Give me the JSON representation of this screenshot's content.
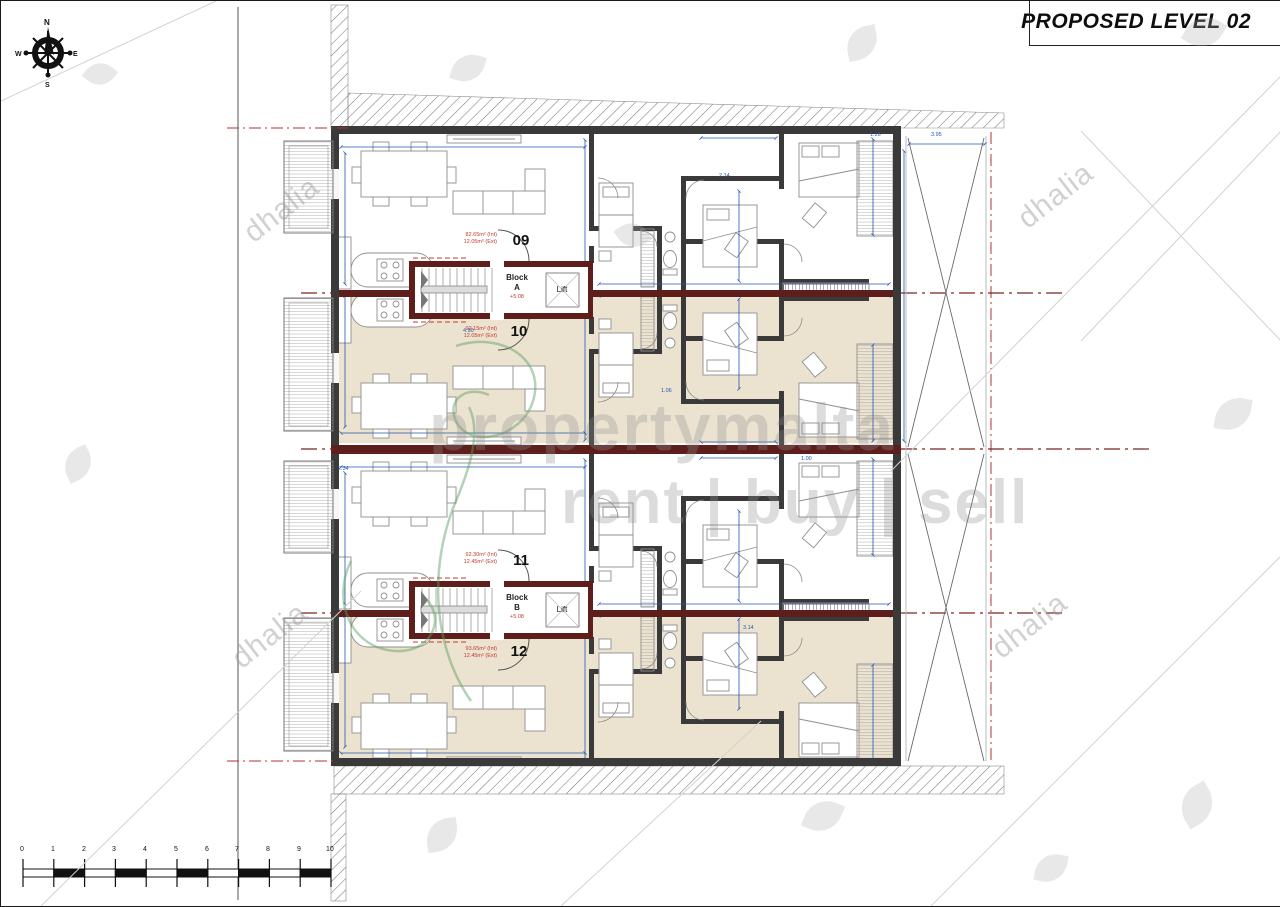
{
  "title": "PROPOSED LEVEL 02",
  "compass": {
    "north": "N",
    "east": "E",
    "south": "S",
    "west": "W"
  },
  "core_a": {
    "name_line1": "Block",
    "name_line2": "A",
    "level": "+5.08",
    "lift_label": "Lift"
  },
  "core_b": {
    "name_line1": "Block",
    "name_line2": "B",
    "level": "+5.08",
    "lift_label": "Lift"
  },
  "units": [
    {
      "number": "09",
      "area_internal": "82.65m² (Int)",
      "area_external": "12.05m² (Ext)"
    },
    {
      "number": "10",
      "area_internal": "92.15m² (Int)",
      "area_external": "12.05m² (Ext)"
    },
    {
      "number": "11",
      "area_internal": "92.30m² (Int)",
      "area_external": "12.45m² (Ext)"
    },
    {
      "number": "12",
      "area_internal": "93.65m² (Int)",
      "area_external": "12.45m² (Ext)"
    }
  ],
  "dimensions": [
    "2.14",
    "3.14",
    "1.06",
    "1.26",
    "3.95",
    "4.90",
    "2.34",
    "1.00"
  ],
  "scale_bar": {
    "labels": [
      "0",
      "1",
      "2",
      "3",
      "4",
      "5",
      "6",
      "7",
      "8",
      "9",
      "10"
    ]
  },
  "watermarks": {
    "brand": "propertymalta",
    "tagline": "rent | buy | sell",
    "agency": "dhalia"
  },
  "colors": {
    "wall": "#3a3a3a",
    "core_wall": "#5e1f1c",
    "floor_beige": "#ece2d0",
    "dimension_blue": "#2059b0",
    "annotation_red": "#c23b2e",
    "boundary_red": "#b23331"
  }
}
